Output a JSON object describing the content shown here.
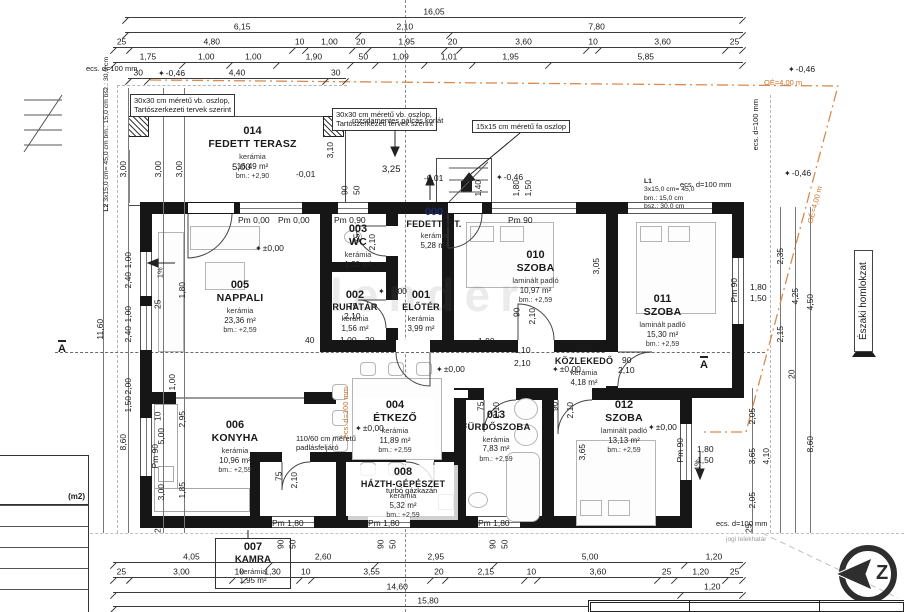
{
  "rooms": [
    {
      "id": "014",
      "name": "FEDETT TERASZ",
      "finish": "kerámia",
      "area": "16,49 m²",
      "height": "bm.: +2,90"
    },
    {
      "id": "000",
      "name": "FEDETT E.T.",
      "finish": "kerámia",
      "area": "5,28 m²",
      "height": ""
    },
    {
      "id": "005",
      "name": "NAPPALI",
      "finish": "kerámia",
      "area": "23,36 m²",
      "height": "bm.: +2,59"
    },
    {
      "id": "003",
      "name": "WC",
      "finish": "kerámia",
      "area": "1,20 m²",
      "height": ""
    },
    {
      "id": "002",
      "name": "RUHATÁR",
      "finish": "kerámia",
      "area": "1,56 m²",
      "height": ""
    },
    {
      "id": "001",
      "name": "ELŐTÉR",
      "finish": "kerámia",
      "area": "3,99 m²",
      "height": ""
    },
    {
      "id": "010",
      "name": "SZOBA",
      "finish": "laminált padló",
      "area": "10,97 m²",
      "height": "bm.: +2,59"
    },
    {
      "id": "011",
      "name": "SZOBA",
      "finish": "laminált padló",
      "area": "15,30 m²",
      "height": "bm.: +2,59"
    },
    {
      "id": "009",
      "name": "KÖZLEKEDŐ",
      "finish": "kerámia",
      "area": "4,18 m²",
      "height": ""
    },
    {
      "id": "004",
      "name": "ÉTKEZŐ",
      "finish": "kerámia",
      "area": "11,89 m²",
      "height": "bm.: +2,59"
    },
    {
      "id": "006",
      "name": "KONYHA",
      "finish": "kerámia",
      "area": "10,96 m²",
      "height": "bm.: +2,59"
    },
    {
      "id": "008",
      "name": "HÁZTH-GÉPÉSZET",
      "finish": "kerámia",
      "area": "5,32 m²",
      "height": "bm.: +2,59"
    },
    {
      "id": "013",
      "name": "FÜRDŐSZOBA",
      "finish": "kerámia",
      "area": "7,83 m²",
      "height": "bm.: +2,59"
    },
    {
      "id": "012",
      "name": "SZOBA",
      "finish": "laminált padló",
      "area": "13,13 m²",
      "height": "bm.: +2,59"
    },
    {
      "id": "007",
      "name": "KAMRA",
      "finish": "kerámia",
      "area": "1,95 m²",
      "height": ""
    }
  ],
  "dims": {
    "top1": [
      "16,05"
    ],
    "top2": [
      "6,15",
      "2,10",
      "7,80"
    ],
    "top3": [
      "25",
      "4,80",
      "10",
      "1,00",
      "20",
      "1,95",
      "20",
      "3,60",
      "10",
      "3,60",
      "25"
    ],
    "top4": [
      "1,75",
      "1,00",
      "1,00",
      "1,90",
      "50",
      "1,09",
      "1,01",
      "1,95",
      "5,85"
    ],
    "top5": [
      "30",
      "4,40",
      "30"
    ],
    "bot1": [
      "4,05",
      "2,60",
      "2,95",
      "5,00",
      "1,20"
    ],
    "bot2": [
      "25",
      "3,00",
      "10",
      "1,30",
      "10",
      "3,55",
      "20",
      "2,15",
      "10",
      "3,60",
      "25",
      "1,20",
      "25"
    ],
    "bot3": [
      "14,60",
      "1,20"
    ],
    "bot4": [
      "15,80"
    ],
    "left": [
      "3,00",
      "3,00",
      "3,00",
      "11,60",
      "25",
      "1,80",
      "1,00",
      "5,00",
      "8,60",
      "10",
      "2,95",
      "3,00",
      "1,85",
      "25"
    ],
    "right": [
      "2,35",
      "4,25",
      "4,50",
      "2,15",
      "20",
      "8,60",
      "2,05",
      "3,65",
      "4,10",
      "2,05",
      "25",
      "3,05",
      "1,80",
      "1,50",
      "1,80",
      "1,50"
    ],
    "wallL": [
      "1,00",
      "2,40",
      "1,00",
      "2,40",
      "2,00",
      "1,50"
    ],
    "inner": [
      "5,00",
      "3,25",
      "-0,01",
      "-0,01",
      "1,90",
      "1,10",
      "2,10",
      "40",
      "10",
      "1,00",
      "20",
      "3,10",
      "1,40",
      "1,80",
      "1,50",
      "3,65",
      "90",
      "50",
      "90",
      "50",
      "90",
      "50",
      "90",
      "50"
    ],
    "doors": [
      "75",
      "2,10",
      "75",
      "2,10",
      "90",
      "2,10",
      "90",
      "2,10",
      "90",
      "2,10",
      "75",
      "2,10",
      "75",
      "2,10"
    ]
  },
  "pm": [
    "Pm 0,00",
    "Pm 0,00",
    "Pm 0,90",
    "Pm 90",
    "Pm 90",
    "Pm 90",
    "Pm 90",
    "Pm 1,80",
    "Pm 1,80",
    "Pm 1,80"
  ],
  "elev": {
    "zero": "±0,00",
    "m046": "-0,46",
    "m001": "-0,01"
  },
  "icons": {
    "elevation": "✦"
  },
  "notes": {
    "col_vb1": "30x30 cm méretű vb. oszlop,",
    "col_vb2": "Tartószerkezeti tervek szerint",
    "railing": "rozsdamentes pálcás korlát",
    "col_wood": "15x15 cm méretű fa oszlop",
    "attic1": "110/60 cm méretű",
    "attic2": "padlásfeljáró",
    "boiler": "turbó gázkazán",
    "ecs": "ecs. d=100 mm",
    "boundary": "jogi telekhatár",
    "roof": "OÉ=4,00 m",
    "facade": "Északi homlokzat",
    "slope": "1%"
  },
  "stairs": {
    "l1_id": "L1",
    "l1_a": "3x15,0 cm= 45,0",
    "l1_b": "bm.: 15,0 cm",
    "l1_c": "bsz.: 30,0 cm",
    "l2_id": "L2",
    "l2_a": "3x15,0 cm= 45,0 cm",
    "l2_b": "bm.: 15,0 cm",
    "l2_c": "bsz.: 30,0 cm"
  },
  "compass_letter": "Z",
  "section_label": "A",
  "legend_header": "(m2)",
  "watermark": "lender"
}
